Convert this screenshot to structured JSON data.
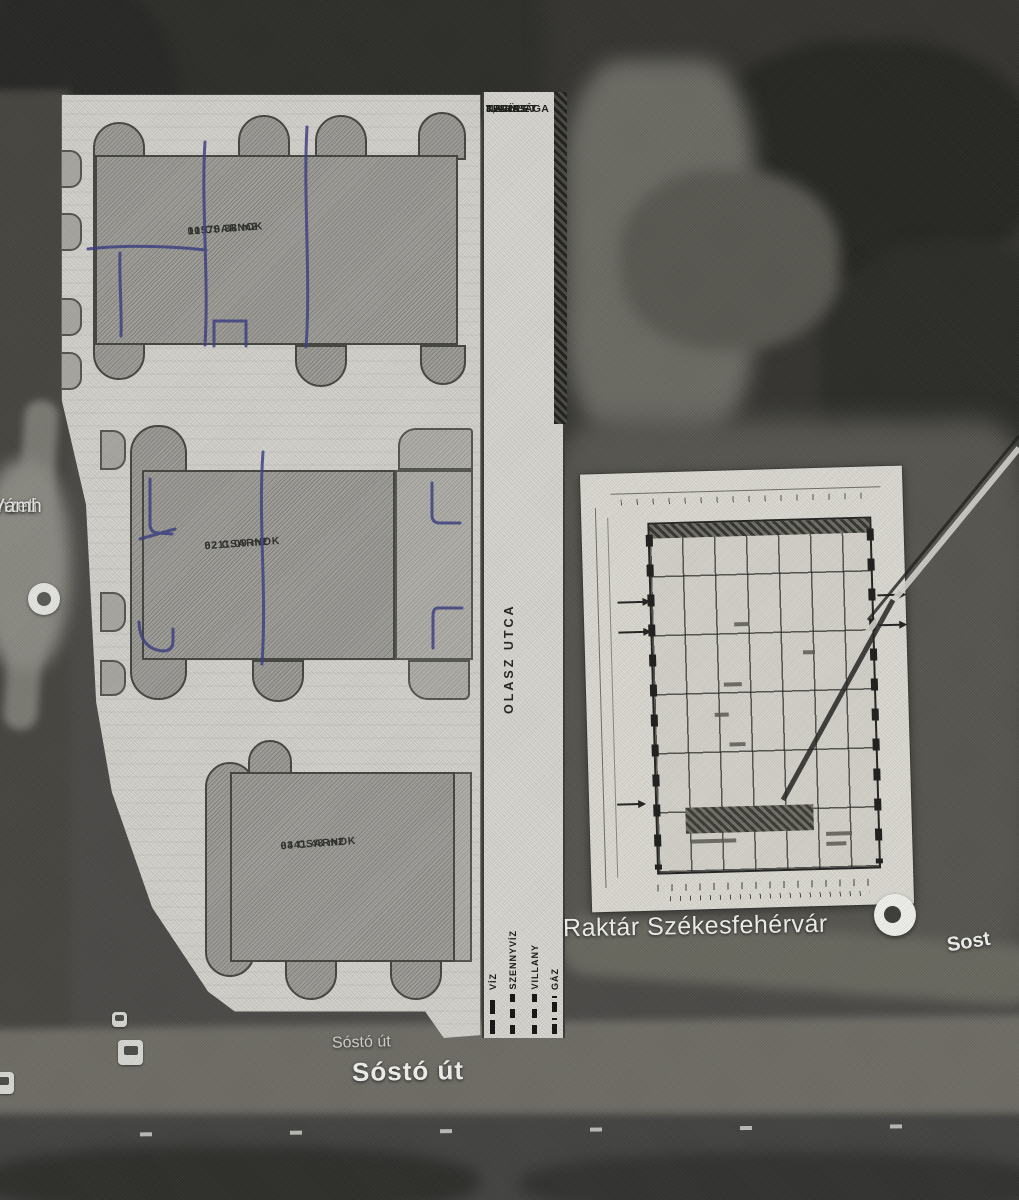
{
  "site_plan": {
    "area_note": {
      "lines": [
        "TELJES",
        "TERÜLET",
        "NAGYSÁGA",
        "3,8 HA"
      ]
    },
    "buildings": [
      {
        "name": "01 CSARNOK",
        "area": "10570.38 m2"
      },
      {
        "name": "02 CSARNOK",
        "area": "5211.09 m2"
      },
      {
        "name": "03 CSARNOK",
        "area": "6441.48 m2"
      }
    ],
    "road_label": "OLASZ UTCA",
    "legend": {
      "items": [
        "VÍZ",
        "SZENNYVÍZ",
        "VILLANY",
        "GÁZ"
      ]
    }
  },
  "map_labels": {
    "warehouse": "Raktár Székesfehérvár",
    "street_small": "Sóstó út",
    "street_large": "Sóstó út",
    "street_partial_right": "Sost",
    "left_poi_line1": "mzeti",
    "left_poi_line2": "Vámh"
  },
  "icons": {
    "map_pin": "white circle pin",
    "left_poi": "white circle poi",
    "bus_stop": "rounded square transit icon"
  },
  "colors": {
    "paper": "#d7d5cf",
    "building_fill": "#a1a09b",
    "pen_ink": "#3c3f82",
    "satellite_dark": "#34332f",
    "road": "#6e6c65",
    "label_white": "#f2f2ef",
    "text_dark": "#1c1c1a"
  }
}
